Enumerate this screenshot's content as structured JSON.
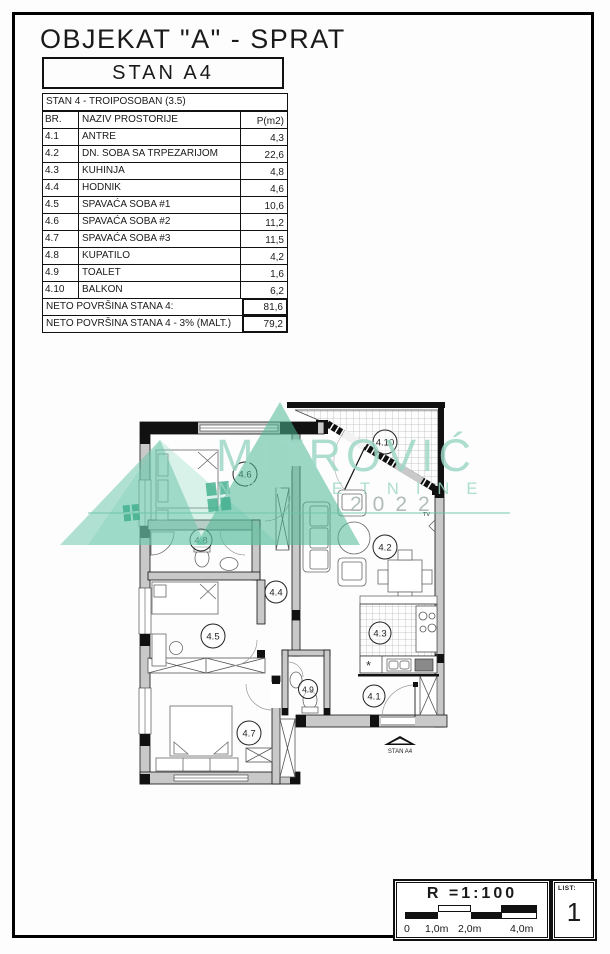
{
  "header": {
    "title": "OBJEKAT \"A\" - SPRAT",
    "unit": "STAN A4"
  },
  "table": {
    "title": "STAN 4 - TROIPOSOBAN (3.5)",
    "columns": {
      "br": "BR.",
      "name": "NAZIV PROSTORIJE",
      "area": "P(m2)"
    },
    "rows": [
      {
        "br": "4.1",
        "name": "ANTRE",
        "area": "4,3"
      },
      {
        "br": "4.2",
        "name": "DN. SOBA SA TRPEZARIJOM",
        "area": "22,6"
      },
      {
        "br": "4.3",
        "name": "KUHINJA",
        "area": "4,8"
      },
      {
        "br": "4.4",
        "name": "HODNIK",
        "area": "4,6"
      },
      {
        "br": "4.5",
        "name": "SPAVAĆA SOBA #1",
        "area": "10,6"
      },
      {
        "br": "4.6",
        "name": "SPAVAĆA SOBA #2",
        "area": "11,2"
      },
      {
        "br": "4.7",
        "name": "SPAVAĆA SOBA #3",
        "area": "11,5"
      },
      {
        "br": "4.8",
        "name": "KUPATILO",
        "area": "4,2"
      },
      {
        "br": "4.9",
        "name": "TOALET",
        "area": "1,6"
      },
      {
        "br": "4.10",
        "name": "BALKON",
        "area": "6,2"
      }
    ],
    "summary": [
      {
        "label": "NETO POVRŠINA STANA 4:",
        "value": "81,6"
      },
      {
        "label": "NETO POVRŠINA STANA 4 - 3% (MALT.)",
        "value": "79,2"
      }
    ]
  },
  "plan": {
    "labels": [
      "4.6",
      "4.10",
      "4.8",
      "4.4",
      "4.5",
      "4.2",
      "4.3",
      "4.9",
      "4.1",
      "4.7"
    ],
    "entrance_label": "STAN A4",
    "tv_label": "TV"
  },
  "watermark": {
    "brand": "MITROVIĆ",
    "line2": "NEKRETNINE",
    "year": "2022",
    "green": "#4cb896",
    "text_green": "#9ed8c6"
  },
  "scale": {
    "ratio": "R =1:100",
    "ticks": [
      "0",
      "1,0m",
      "2,0m",
      "4,0m"
    ]
  },
  "sheet": {
    "label": "LIST:",
    "number": "1"
  }
}
